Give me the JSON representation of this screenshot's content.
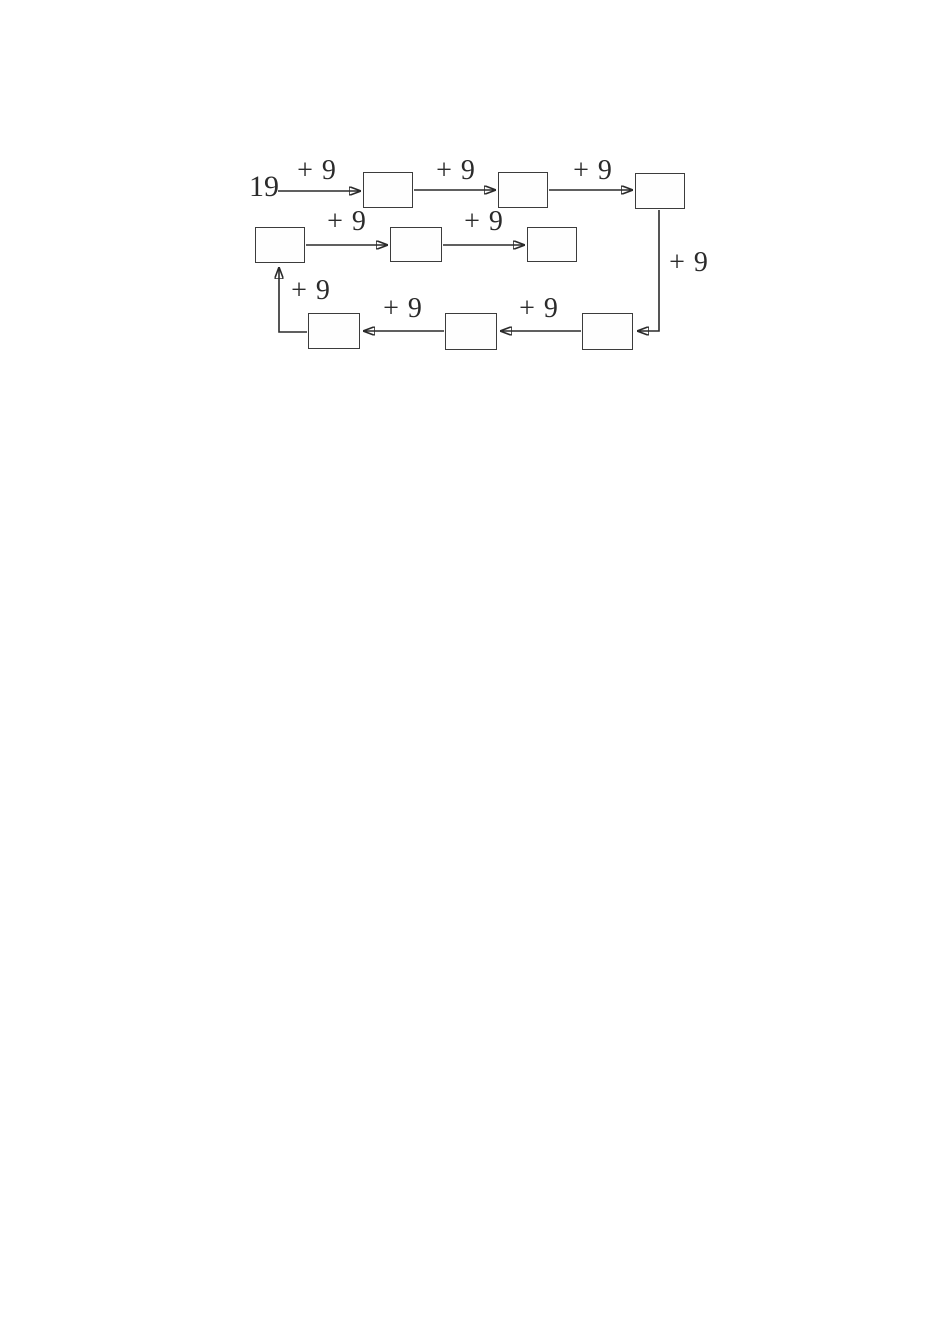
{
  "page": {
    "background_color": "#ffffff",
    "ink_color": "#2b2b2b"
  },
  "diagram": {
    "type": "flow-chain",
    "start_value": "19",
    "operation": "+ 9",
    "boxes": [
      {
        "id": "box1",
        "value": ""
      },
      {
        "id": "box2",
        "value": ""
      },
      {
        "id": "box3",
        "value": ""
      },
      {
        "id": "box4",
        "value": ""
      },
      {
        "id": "box5",
        "value": ""
      },
      {
        "id": "box6",
        "value": ""
      },
      {
        "id": "box7",
        "value": ""
      },
      {
        "id": "box8",
        "value": ""
      },
      {
        "id": "box9",
        "value": ""
      }
    ],
    "edges": [
      {
        "from": "start",
        "to": "box1",
        "label": "+ 9",
        "direction": "right"
      },
      {
        "from": "box1",
        "to": "box2",
        "label": "+ 9",
        "direction": "right"
      },
      {
        "from": "box2",
        "to": "box3",
        "label": "+ 9",
        "direction": "right"
      },
      {
        "from": "box3",
        "to": "box4",
        "label": "+ 9",
        "direction": "down-then-left"
      },
      {
        "from": "box4",
        "to": "box5",
        "label": "+ 9",
        "direction": "left"
      },
      {
        "from": "box5",
        "to": "box6",
        "label": "+ 9",
        "direction": "left"
      },
      {
        "from": "box6",
        "to": "box7",
        "label": "+ 9",
        "direction": "left-then-up"
      },
      {
        "from": "box7",
        "to": "box8",
        "label": "+ 9",
        "direction": "right"
      },
      {
        "from": "box8",
        "to": "box9",
        "label": "+ 9",
        "direction": "right"
      }
    ]
  }
}
